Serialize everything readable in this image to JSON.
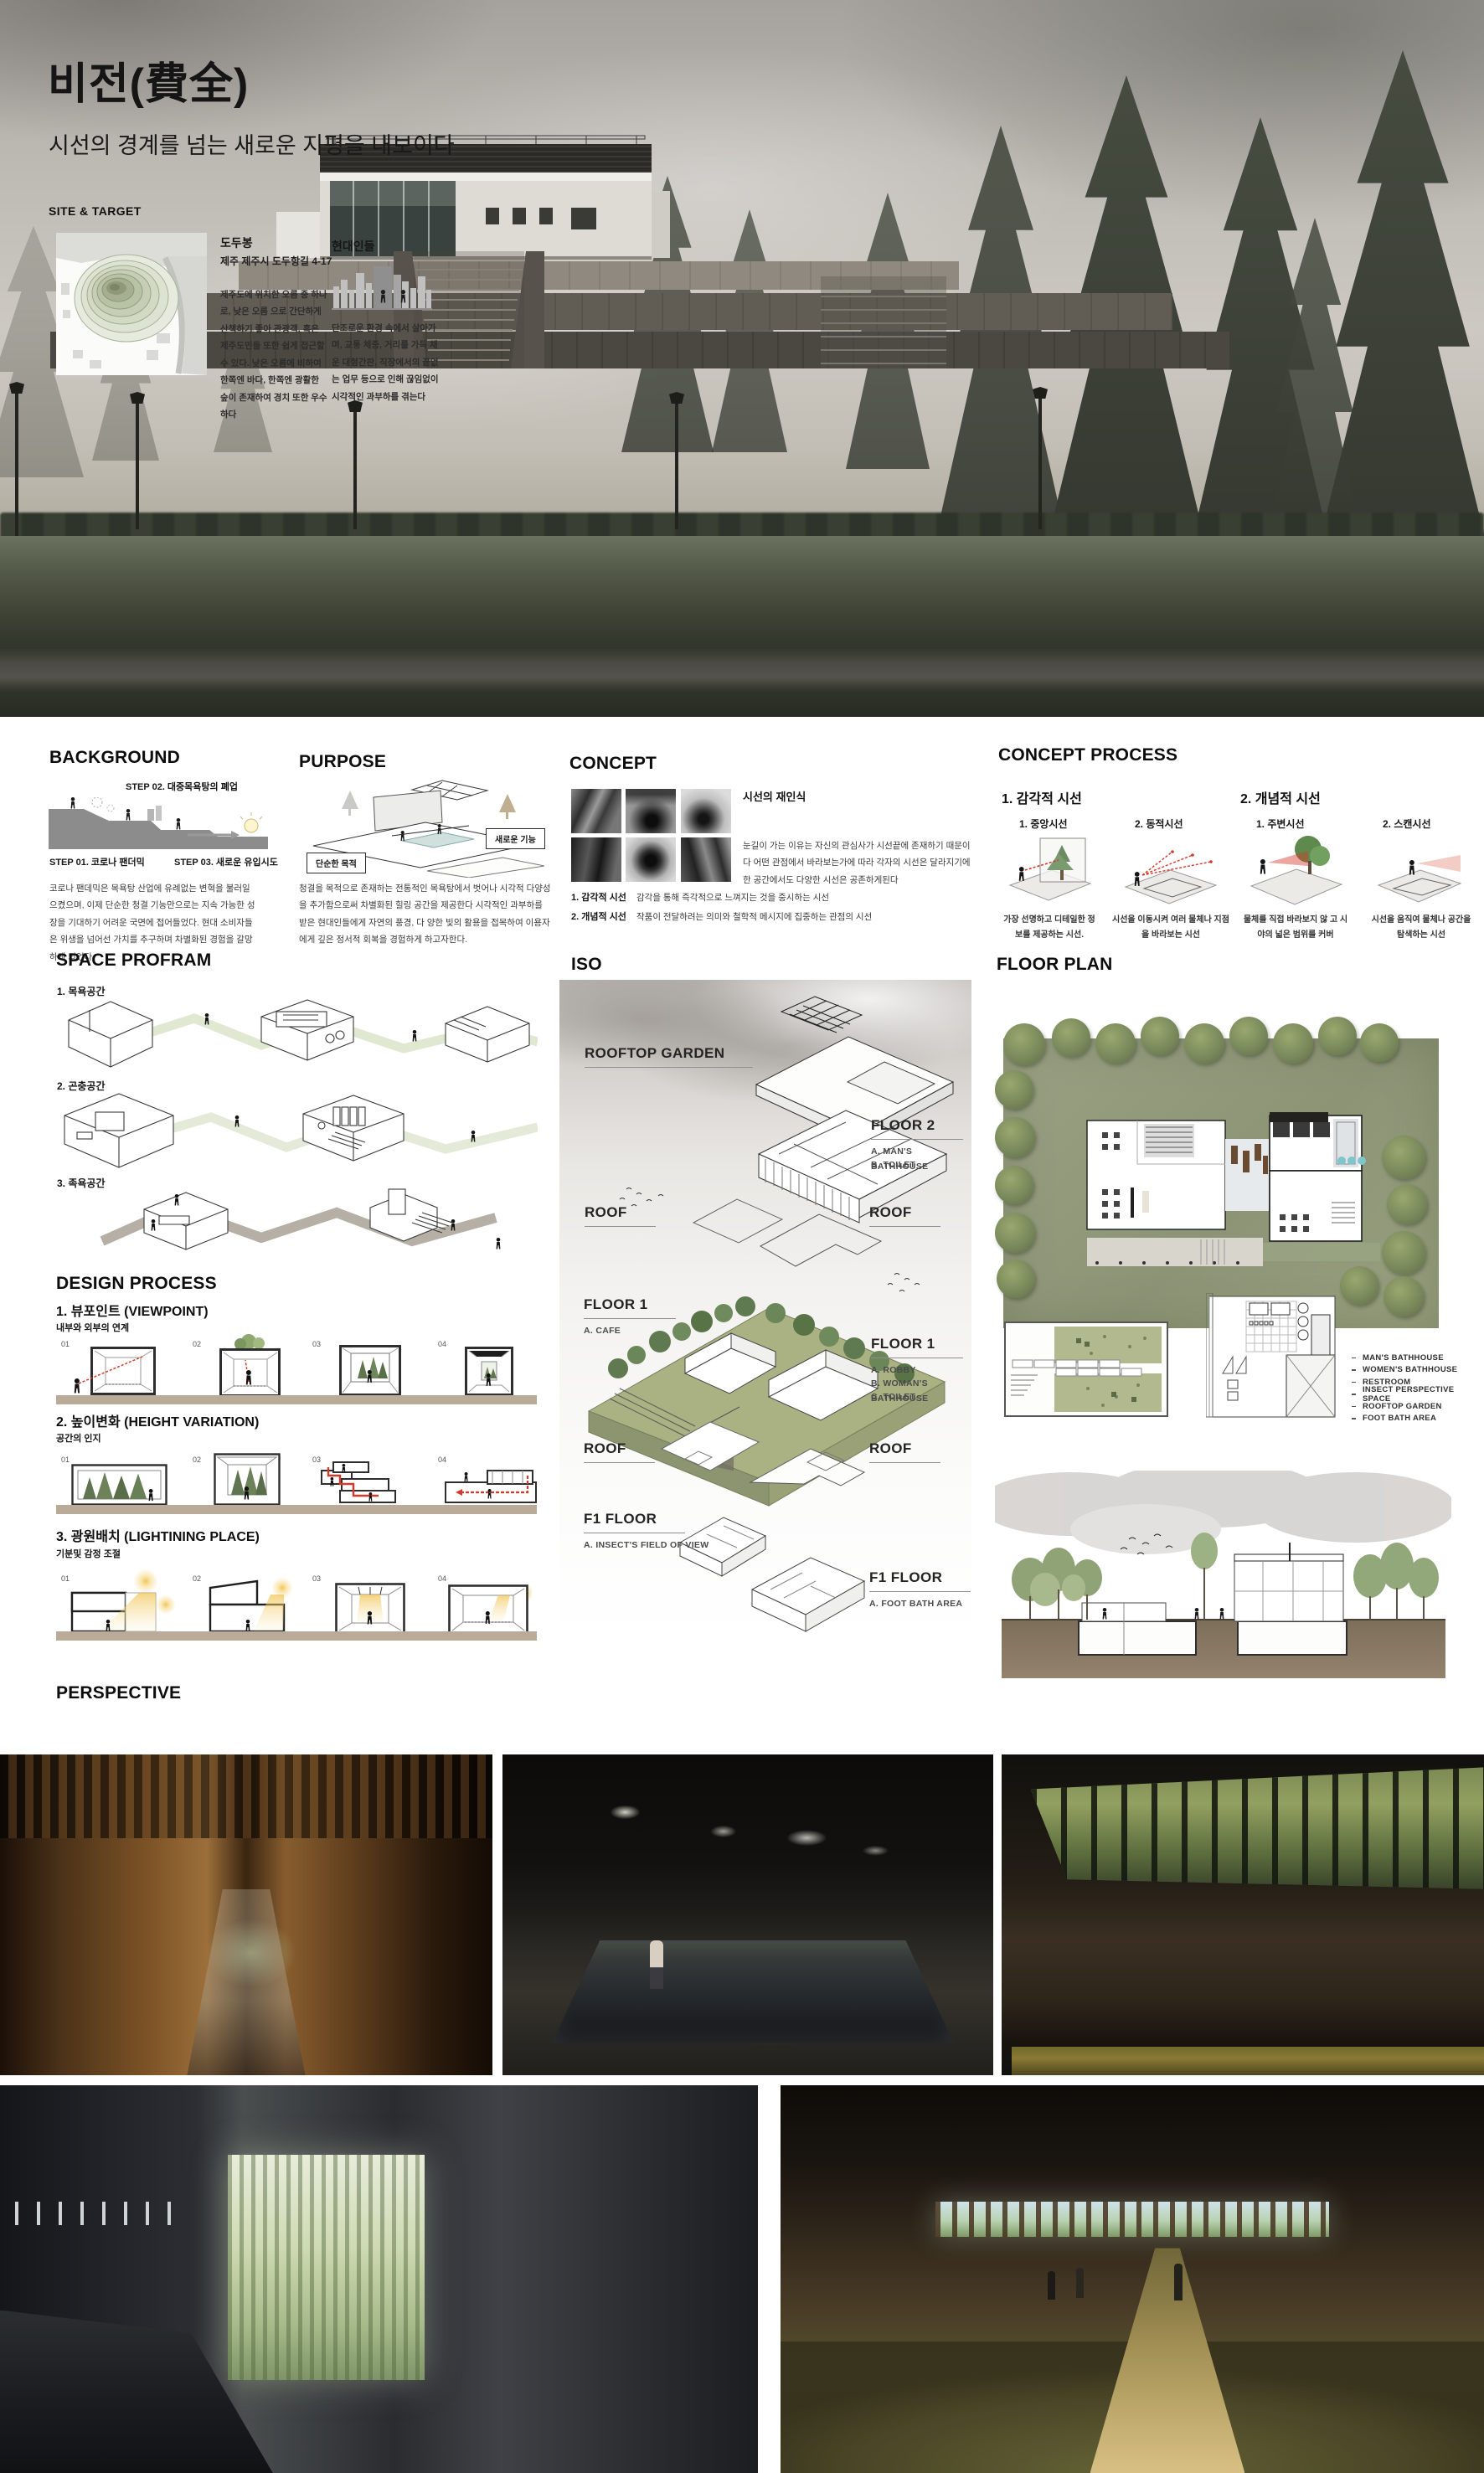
{
  "hero": {
    "title": "비전(費全)",
    "subtitle": "시선의 경계를 넘는 새로운 지평을 내보이다",
    "site_target_heading": "SITE & TARGET",
    "site_name": "도두봉",
    "site_address": "제주 제주시 도두항길 4-17",
    "site_description": "제주도에 위치한 오름 중 하나로, 낮은 오름 으로 간단하게 산책하기 좋아 관광객, 혹은 제주도민들 또한 쉽게 접근할 수 있다. 낮은 오름에 비하여 한쪽엔 바다, 한쪽엔 광활한 숲이 존재하여 경치 또한 우수하다",
    "target_name": "현대인들",
    "target_description": "단조로운 환경 속에서 살아가며, 교통 체증, 거리를 가득 채운 대형간판, 직장에서의 끝없는 업무 등으로 인해 끊임없이 시각적인 과부하를 겪는다"
  },
  "background": {
    "heading": "BACKGROUND",
    "step1": "STEP 01. 코로나 팬더믹",
    "step2": "STEP 02. 대중목욕탕의 폐업",
    "step3": "STEP 03.  새로운 유입시도",
    "description": "코로나 팬데믹은 목욕탕 산업에 유례없는 변혁을 불러일으켰으며, 이제 단순한 청결 기능만으로는 지속 가능한 성장을 기대하기 어려운 국면에 접어들었다. 현대 소비자들은 위생을 넘어선 가치를 추구하며 차별화된 경험을 갈망하게 되었다"
  },
  "purpose": {
    "heading": "PURPOSE",
    "label_left": "단순한 목적",
    "label_right": "새로운 기능",
    "description": "청결을 목적으로 존재하는 전통적인 목욕탕에서 벗어나 시각적 다양성을 추가함으로써 차별화된 힐링 공간을 제공한다 시각적인 과부하를 받은 현대인들에게 자연의 풍경, 다 양한 빛의 활용을 접목하여 이용자에게 깊은 정서적 회복을 경험하게 하고자한다."
  },
  "concept": {
    "heading": "CONCEPT",
    "subheading": "시선의 재인식",
    "description": "눈길이 가는 이유는 자신의 관심사가 시선끝에 존재하기 때문이다 어떤 관점에서 바라보는가에 따라 각자의 시선은 달라지기에 한 공간에서도 다양한 시선은 공존하게된다",
    "item1_label": "1. 감각적 시선",
    "item1_text": "감각을 통해 즉각적으로 느껴지는 것을 중시하는 시선",
    "item2_label": "2. 개념적 시선",
    "item2_text": "작품이 전달하려는 의미와 철학적 메시지에 집중하는 관점의 시선"
  },
  "concept_process": {
    "heading": "CONCEPT PROCESS",
    "group1_label": "1. 감각적 시선",
    "group2_label": "2. 개념적 시선",
    "items": [
      {
        "label": "1. 중앙시선",
        "caption": "가장 선명하고 디테일한  정보를 제공하는 시선."
      },
      {
        "label": "2. 동적시선",
        "caption": "시선을 이동시켜 여러 물체나 지점을 바라보는 시선"
      },
      {
        "label": "1. 주변시선",
        "caption": "물체를 직접 바라보지 않 고 시야의 넓은 범위를 커버"
      },
      {
        "label": "2. 스캔시선",
        "caption": "시선을 움직여 물체나 공간을 탐색하는 시선"
      }
    ]
  },
  "space_program": {
    "heading": "SPACE PROFRAM",
    "item1": "1. 목욕공간",
    "item2": "2. 곤충공간",
    "item3": "3. 족욕공간"
  },
  "iso": {
    "heading": "ISO",
    "rooftop_garden": "ROOFTOP GARDEN",
    "floor2_title": "FLOOR 2",
    "floor2_a": "A. MAN'S BATHHOUSE",
    "floor2_b": "B. TOILET",
    "roof_l1": "ROOF",
    "roof_r1": "ROOF",
    "floor1l_title": "FLOOR 1",
    "floor1l_a": "A. CAFE",
    "floor1r_title": "FLOOR 1",
    "floor1r_a": "A. ROBBY",
    "floor1r_b": "B. WOMAN'S BATHHOUSE",
    "floor1r_c": "C. TOILET",
    "roof_l2": "ROOF",
    "roof_r2": "ROOF",
    "f1l_title": "F1 FLOOR",
    "f1l_a": "A. INSECT'S FIELD OF VIEW",
    "f1r_title": "F1 FLOOR",
    "f1r_a": "A. FOOT BATH AREA"
  },
  "floor_plan": {
    "heading": "FLOOR PLAN",
    "legend": [
      "MAN'S BATHHOUSE",
      "WOMEN'S BATHHOUSE",
      "RESTROOM",
      "INSECT PERSPECTIVE SPACE",
      "ROOFTOP GARDEN",
      "FOOT BATH AREA"
    ]
  },
  "design_process": {
    "heading": "DESIGN PROCESS",
    "sections": [
      {
        "title": "1.  뷰포인트 (VIEWPOINT)",
        "subtitle": "내부와 외부의 연계",
        "frames": [
          "01",
          "02",
          "03",
          "04"
        ]
      },
      {
        "title": "2. 높이변화 (HEIGHT VARIATION)",
        "subtitle": "공간의 인지",
        "frames": [
          "01",
          "02",
          "03",
          "04"
        ]
      },
      {
        "title": "3. 광원배치 (LIGHTINING PLACE)",
        "subtitle": "기분및  감정 조절",
        "frames": [
          "01",
          "02",
          "03",
          "04"
        ]
      }
    ]
  },
  "perspective": {
    "heading": "PERSPECTIVE"
  },
  "colors": {
    "sight_red": "#d43a2c",
    "ground_tan": "#b9ab97",
    "plan_green": "#99a07e",
    "ribbon_green": "#dde5cd"
  }
}
